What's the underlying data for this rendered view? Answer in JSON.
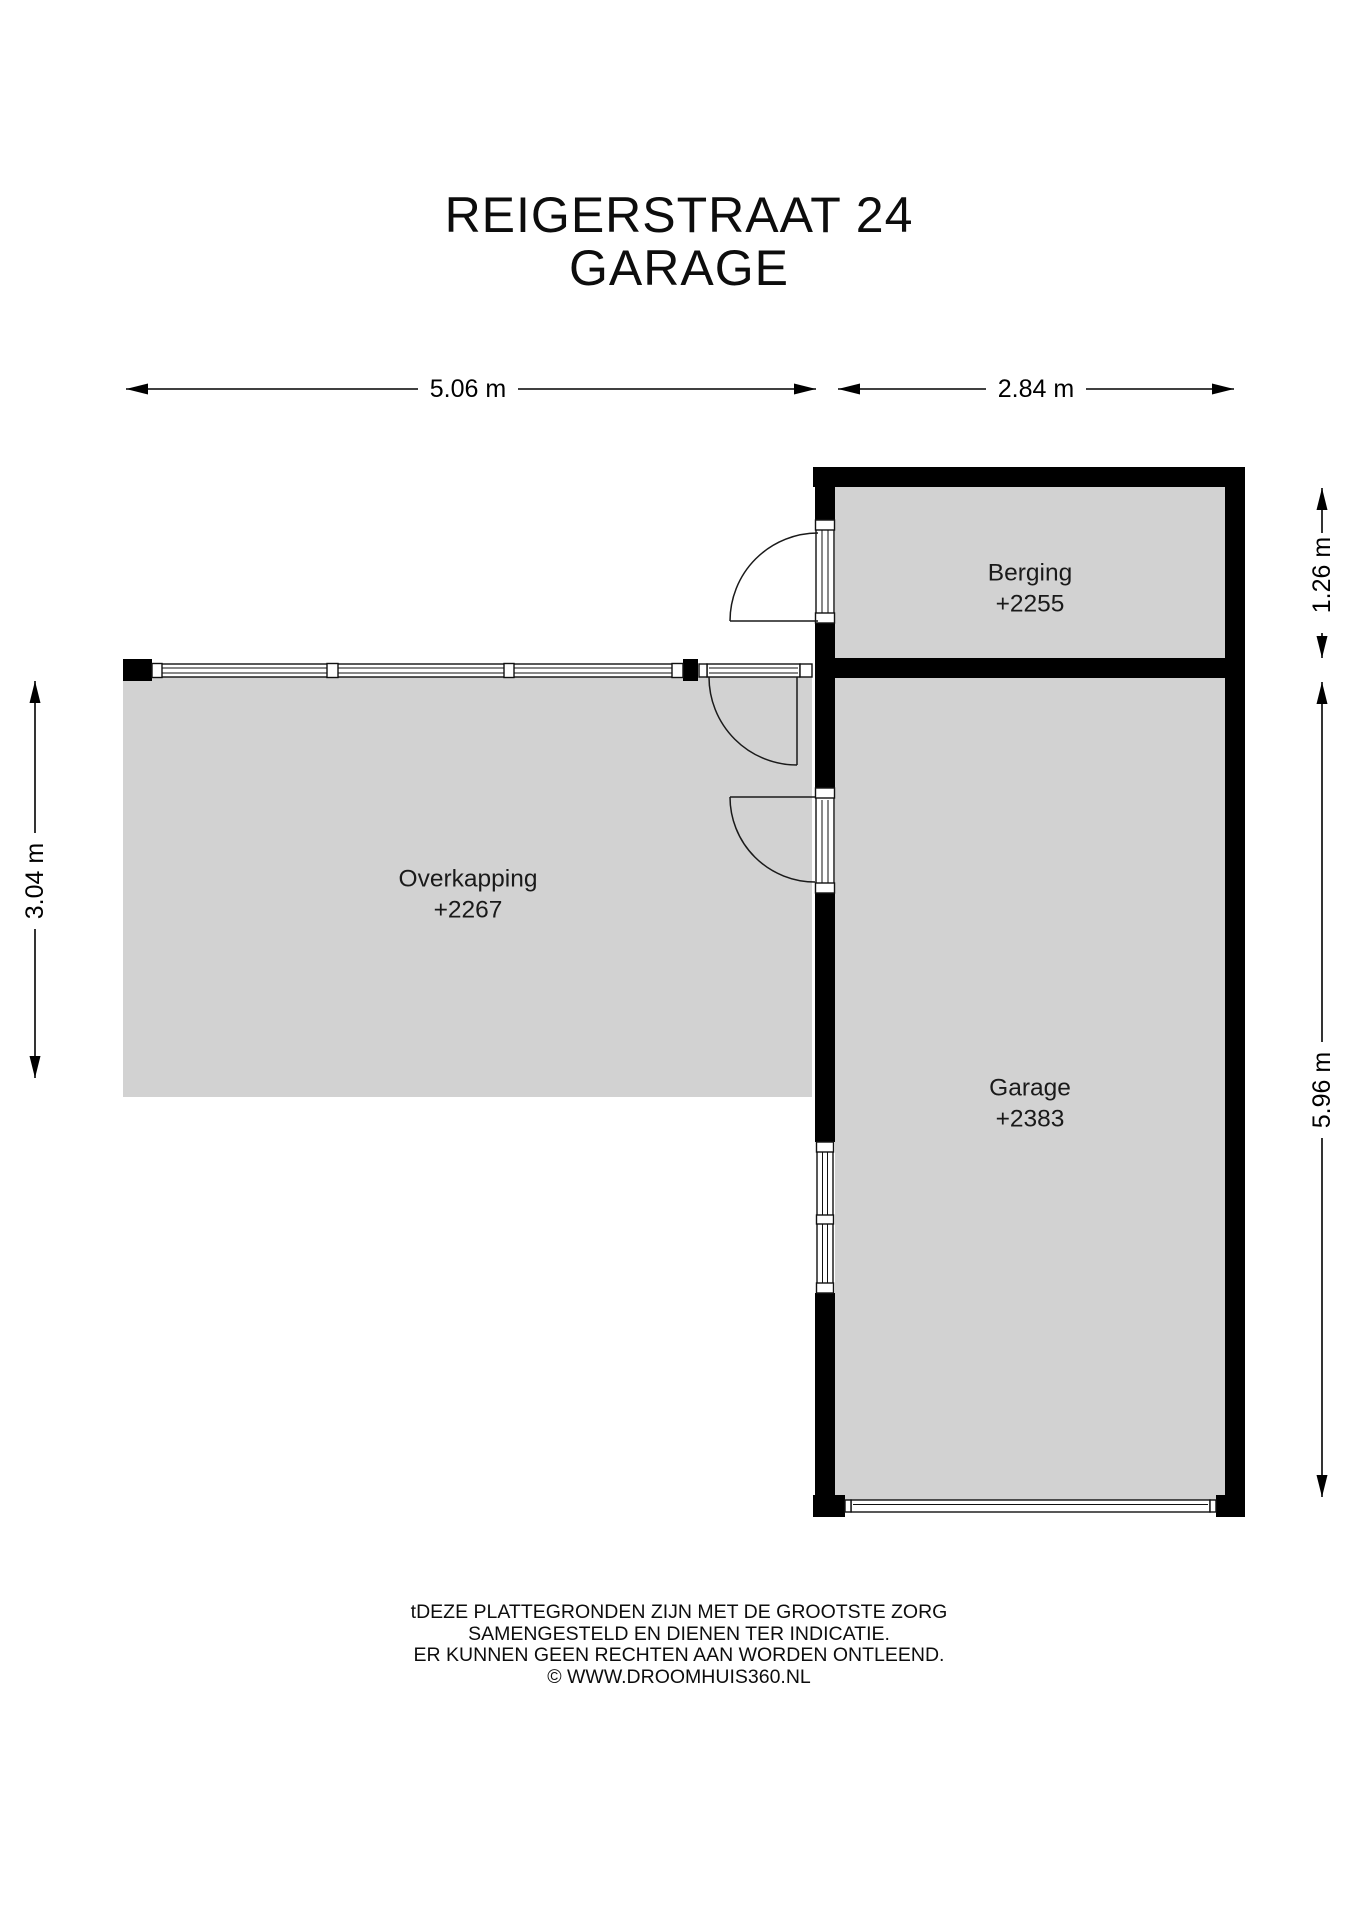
{
  "title": {
    "line1": "REIGERSTRAAT 24",
    "line2": "GARAGE"
  },
  "rooms": {
    "berging": {
      "name": "Berging",
      "elevation": "+2255"
    },
    "garage": {
      "name": "Garage",
      "elevation": "+2383"
    },
    "overkapping": {
      "name": "Overkapping",
      "elevation": "+2267"
    }
  },
  "dimensions": {
    "overkapping_width": "5.06 m",
    "garage_width": "2.84 m",
    "berging_depth": "1.26 m",
    "garage_depth": "5.96 m",
    "overkapping_depth": "3.04 m"
  },
  "footer": {
    "line1": "tDEZE PLATTEGRONDEN ZIJN MET DE GROOTSTE ZORG",
    "line2": "SAMENGESTELD EN DIENEN TER INDICATIE.",
    "line3": "ER KUNNEN GEEN RECHTEN AAN WORDEN ONTLEEND.",
    "line4": "© WWW.DROOMHUIS360.NL"
  },
  "colors": {
    "wall": "#000000",
    "floor": "#d2d2d2",
    "background": "#ffffff"
  }
}
